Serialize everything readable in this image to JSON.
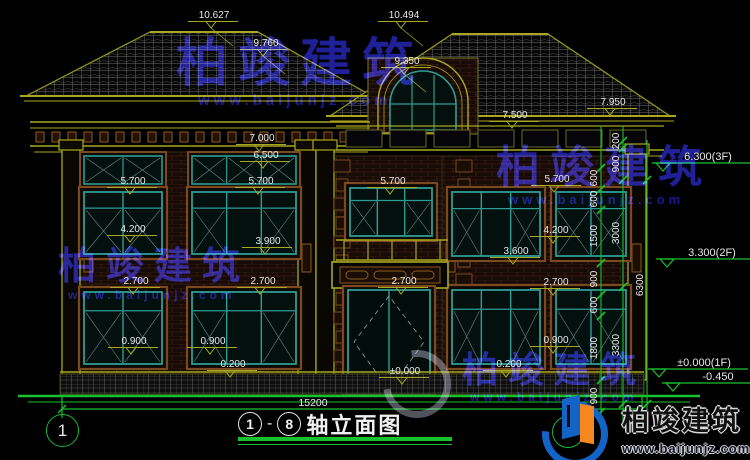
{
  "watermark": {
    "name": "柏竣建筑",
    "url": "www.baijunjz.com"
  },
  "brand": {
    "name": "柏竣建筑",
    "url": "www.baijunjz.com"
  },
  "bottom": {
    "overall_dim": "15200",
    "axis_left_bubble": "1",
    "title_axis_from": "1",
    "title_dash": "-",
    "title_axis_to": "8",
    "title": "轴立面图"
  },
  "colors": {
    "cad_green": "#17c22e",
    "olive": "#a8a820",
    "teal": "#2d9d94",
    "brick_line": "#53281a",
    "brown": "#7a4a1e",
    "white_text": "#e8e8e8",
    "watermark_blue": "#2222a6",
    "logo_blue": "#1464c8",
    "logo_orange": "#f5871f"
  },
  "elevation_labels": [
    {
      "t": "10.627",
      "x": 214,
      "y": 10,
      "leader": 1
    },
    {
      "t": "10.494",
      "x": 404,
      "y": 10,
      "leader": 1
    },
    {
      "t": "9.760",
      "x": 266,
      "y": 38,
      "leader": 1
    },
    {
      "t": "9.350",
      "x": 407,
      "y": 56,
      "leader": 1
    },
    {
      "t": "7.950",
      "x": 613,
      "y": 97,
      "leader": 0
    },
    {
      "t": "7.500",
      "x": 515,
      "y": 110,
      "leader": 0
    },
    {
      "t": "7.000",
      "x": 262,
      "y": 133,
      "leader": 0
    },
    {
      "t": "6.500",
      "x": 266,
      "y": 150,
      "leader": 0
    },
    {
      "t": "5.700",
      "x": 133,
      "y": 176,
      "leader": 0
    },
    {
      "t": "5.700",
      "x": 261,
      "y": 176,
      "leader": 0
    },
    {
      "t": "5.700",
      "x": 393,
      "y": 176,
      "leader": 0
    },
    {
      "t": "5.700",
      "x": 557,
      "y": 174,
      "leader": 0
    },
    {
      "t": "4.200",
      "x": 133,
      "y": 224,
      "leader": 0
    },
    {
      "t": "4.200",
      "x": 556,
      "y": 225,
      "leader": 0
    },
    {
      "t": "3.900",
      "x": 268,
      "y": 236,
      "leader": 0
    },
    {
      "t": "3.600",
      "x": 516,
      "y": 246,
      "leader": 0
    },
    {
      "t": "2.700",
      "x": 136,
      "y": 276,
      "leader": 0
    },
    {
      "t": "2.700",
      "x": 263,
      "y": 276,
      "leader": 0
    },
    {
      "t": "2.700",
      "x": 404,
      "y": 276,
      "leader": 0
    },
    {
      "t": "2.700",
      "x": 556,
      "y": 277,
      "leader": 0
    },
    {
      "t": "0.900",
      "x": 134,
      "y": 336,
      "leader": 0
    },
    {
      "t": "0.900",
      "x": 213,
      "y": 336,
      "leader": 0
    },
    {
      "t": "0.900",
      "x": 556,
      "y": 335,
      "leader": 0
    },
    {
      "t": "0.200",
      "x": 233,
      "y": 359,
      "leader": 0
    },
    {
      "t": "0.200",
      "x": 509,
      "y": 359,
      "leader": 0
    },
    {
      "t": "±0.000",
      "x": 405,
      "y": 366,
      "leader": 0
    }
  ],
  "dim_chains": [
    {
      "x": 601,
      "yTop": 126,
      "yBot": 421,
      "segments": [
        {
          "t": "600",
          "y": 178
        },
        {
          "t": "600",
          "y": 199
        },
        {
          "t": "1500",
          "y": 236
        },
        {
          "t": "900",
          "y": 279
        },
        {
          "t": "600",
          "y": 305
        },
        {
          "t": "1800",
          "y": 348
        },
        {
          "t": "900",
          "y": 396
        }
      ],
      "ticks": [
        168,
        189,
        210,
        263,
        295,
        316,
        380,
        412
      ]
    },
    {
      "x": 623,
      "yTop": 126,
      "yBot": 421,
      "segments": [
        {
          "t": "200",
          "y": 141
        },
        {
          "t": "900",
          "y": 164
        },
        {
          "t": "3000",
          "y": 233
        },
        {
          "t": "3300",
          "y": 345
        }
      ],
      "ticks": [
        141,
        148,
        180,
        287,
        404
      ]
    },
    {
      "x": 647,
      "yTop": 140,
      "yBot": 421,
      "segments": [
        {
          "t": "6300",
          "y": 285
        }
      ],
      "ticks": [
        180,
        404
      ]
    }
  ],
  "floor_levels": [
    {
      "t": "6.300(3F)",
      "x": 668,
      "y": 152,
      "lineY": 163
    },
    {
      "t": "3.300(2F)",
      "x": 672,
      "y": 248,
      "lineY": 259
    },
    {
      "t": "±0.000(1F)",
      "x": 664,
      "y": 358,
      "lineY": 369
    },
    {
      "t": "-0.450",
      "x": 678,
      "y": 372,
      "lineY": 383
    }
  ]
}
